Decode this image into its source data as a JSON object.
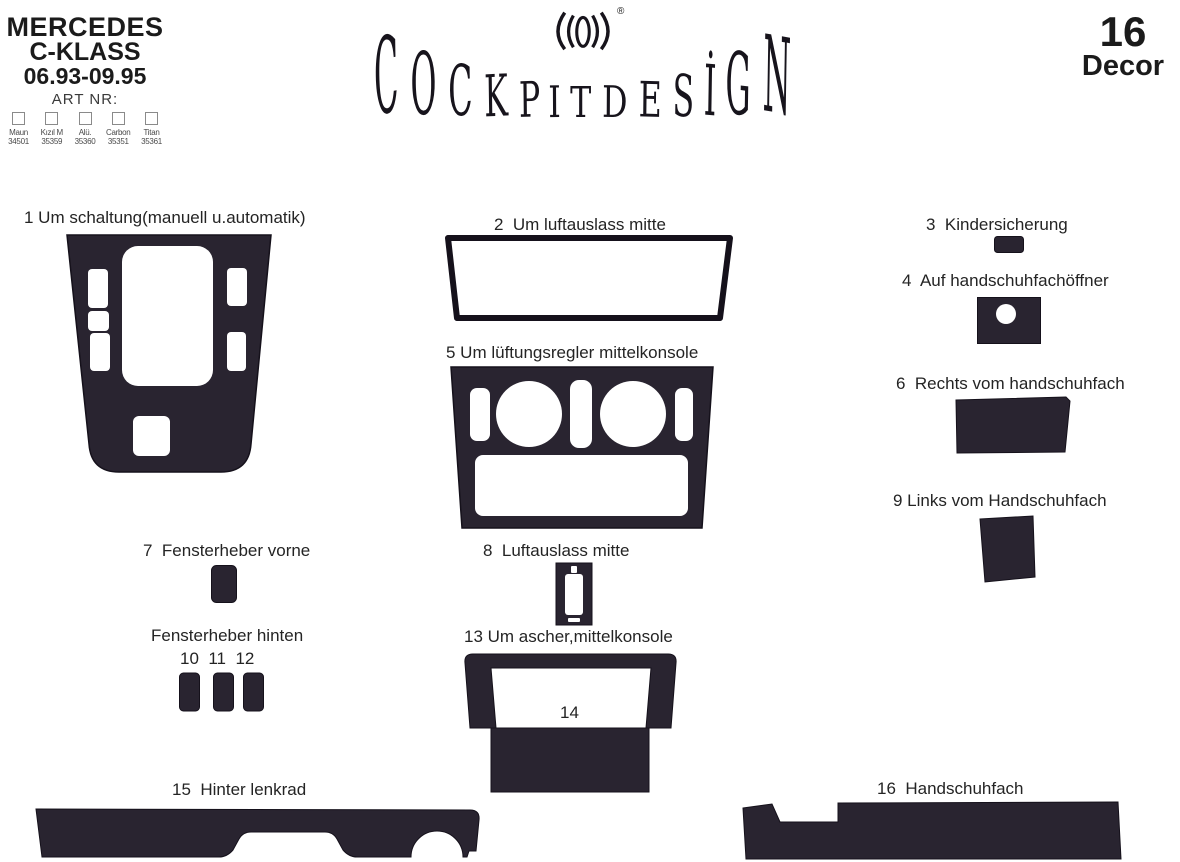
{
  "header": {
    "brand": {
      "line1": "MERCEDES",
      "line2": "C-KLASS",
      "line3": "06.93-09.95",
      "art_nr_label": "ART NR:",
      "variants": [
        {
          "name": "Maun",
          "code": "34501"
        },
        {
          "name": "Kızıl M",
          "code": "35359"
        },
        {
          "name": "Alü.",
          "code": "35360"
        },
        {
          "name": "Carbon",
          "code": "35351"
        },
        {
          "name": "Titan",
          "code": "35361"
        }
      ]
    },
    "logo": {
      "text": "COCKPITDESİGN",
      "registered": "®"
    },
    "piece_count": {
      "number": "16",
      "label": "Decor"
    }
  },
  "parts": {
    "p1": {
      "label": "1 Um schaltung(manuell u.automatik)"
    },
    "p2": {
      "label": "2  Um luftauslass mitte"
    },
    "p3": {
      "label": "3  Kindersicherung"
    },
    "p4": {
      "label": "4  Auf handschuhfachöffner"
    },
    "p5": {
      "label": "5 Um lüftungsregler mittelkonsole"
    },
    "p6": {
      "label": "6  Rechts vom handschuhfach"
    },
    "p7": {
      "label": "7  Fensterheber vorne"
    },
    "p8": {
      "label": "8  Luftauslass mitte"
    },
    "p9": {
      "label": "9 Links vom Handschuhfach"
    },
    "fenster_hinten": {
      "label": "Fensterheber hinten",
      "numbers": "10  11  12"
    },
    "p13": {
      "label": "13 Um ascher,mittelkonsole"
    },
    "p14": {
      "label": "14"
    },
    "p15": {
      "label": "15  Hinter lenkrad"
    },
    "p16": {
      "label": "16  Handschuhfach"
    }
  },
  "colors": {
    "shape_fill": "#292430",
    "shape_outline": "#15111b",
    "label_text": "#242424"
  }
}
